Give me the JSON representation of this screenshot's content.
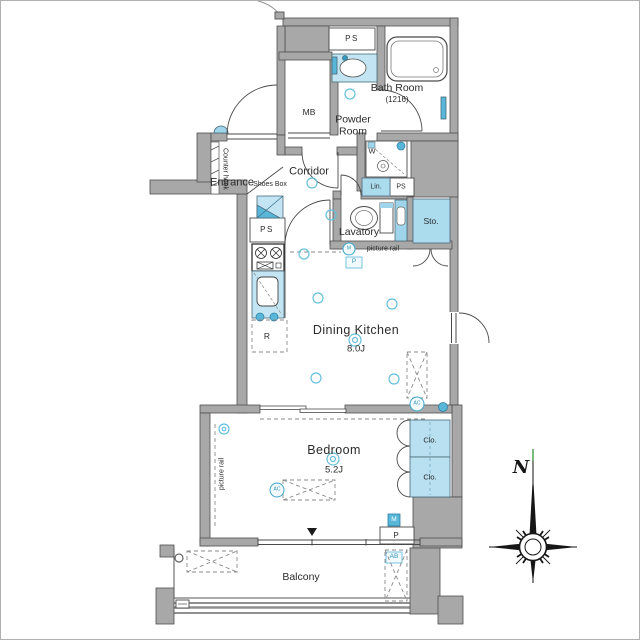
{
  "rooms": {
    "bath_room": {
      "name": "Bath Room",
      "size": "(1216)"
    },
    "powder_room": {
      "name": "Powder Room"
    },
    "entrance": {
      "name": "Entrance"
    },
    "corridor": {
      "name": "Corridor"
    },
    "lavatory": {
      "name": "Lavatory"
    },
    "dining_kitchen": {
      "name": "Dining Kitchen",
      "size": "8.0J"
    },
    "bedroom": {
      "name": "Bedroom",
      "size": "5.2J"
    },
    "balcony": {
      "name": "Balcony"
    }
  },
  "fixtures": {
    "shoes_box": "Shoes Box",
    "counter_hook": "Counter hook",
    "picture_rail": "picture rail",
    "meter_box": "MB",
    "pipe_space": "PS",
    "linen": "Lin.",
    "storage": "Sto.",
    "closet": "Clo.",
    "washer": "W",
    "refrigerator": "R",
    "meter": "M",
    "panel": "P",
    "air_conditioner": "AC",
    "ac_outdoor_unit": "AB"
  },
  "compass": {
    "north_label": "N"
  },
  "colors": {
    "wall_gray": "#a8a8a8",
    "fixture_light_blue": "#c3e5f3",
    "fixture_mid_blue": "#aadcee",
    "accent_blue": "#58b6d9",
    "teal_text": "#2e93b8",
    "light_cyan_stroke": "#66bfdc"
  }
}
